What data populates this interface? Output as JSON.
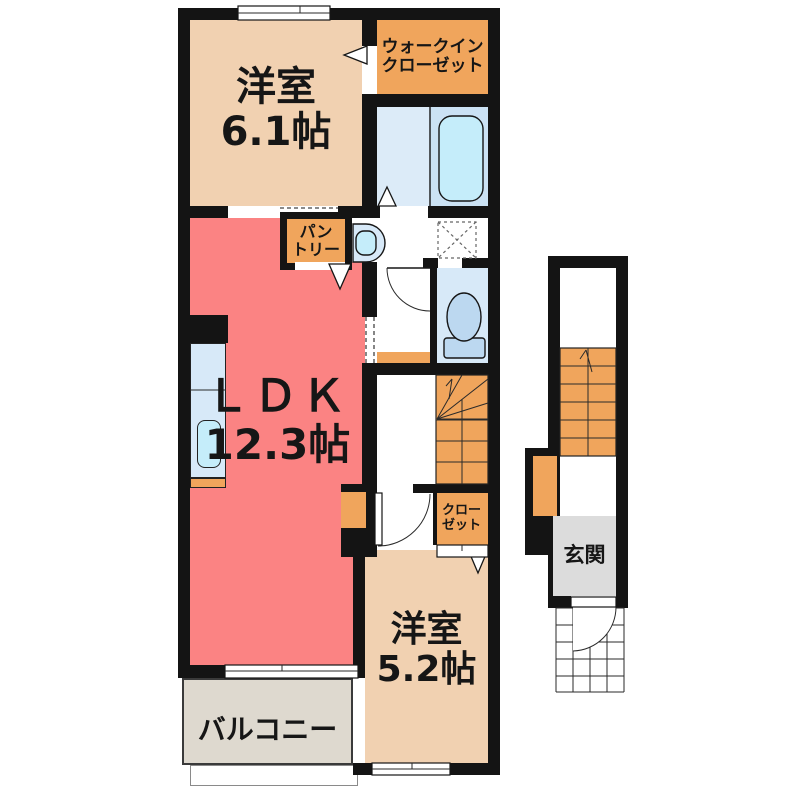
{
  "colors": {
    "wall": "#141414",
    "tan": "#F1D1B1",
    "orange": "#F0A55C",
    "salmon": "#FB8383",
    "bath_floor": "#DCEBF8",
    "bath_tub_zone": "#CBE2F4",
    "fixture_blue": "#C5EDFA",
    "unit_blue": "#D7E9F8",
    "toilet_blue": "#BCD8F0",
    "balcony_gray": "#DED9CF",
    "entrance_gray": "#DCDCDC"
  },
  "rooms": {
    "western1": {
      "name": "洋室",
      "size": "6.1帖"
    },
    "wic": {
      "line1": "ウォークイン",
      "line2": "クローゼット"
    },
    "ldk": {
      "name": "ＬＤＫ",
      "size": "12.3帖"
    },
    "pantry": {
      "line1": "パン",
      "line2": "トリー"
    },
    "closet": {
      "line1": "クロー",
      "line2": "ゼット"
    },
    "western2": {
      "name": "洋室",
      "size": "5.2帖"
    },
    "balcony": {
      "name": "バルコニー"
    },
    "entrance": {
      "name": "玄関"
    }
  }
}
